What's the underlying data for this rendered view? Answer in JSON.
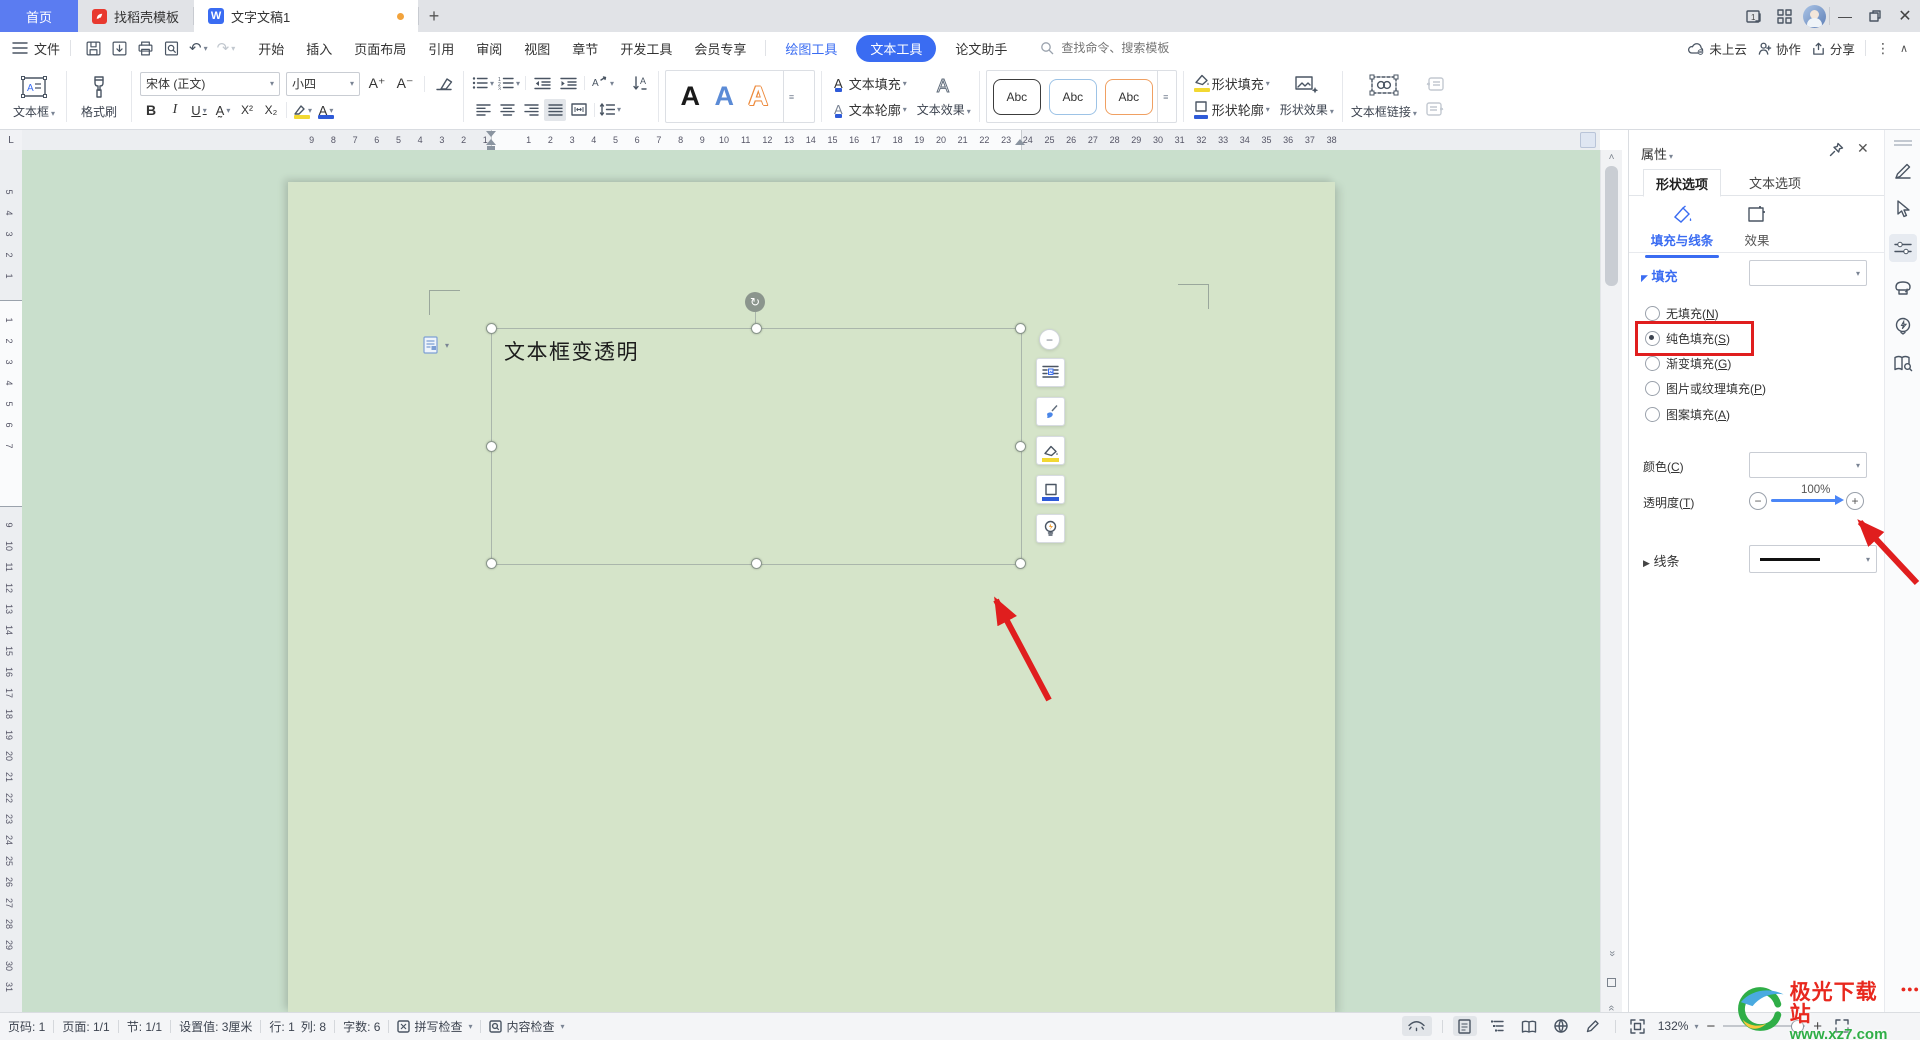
{
  "tabbar": {
    "home": "首页",
    "docer": "找稻壳模板",
    "doc": "文字文稿1"
  },
  "menubar": {
    "file": "文件",
    "items": [
      "开始",
      "插入",
      "页面布局",
      "引用",
      "审阅",
      "视图",
      "章节",
      "开发工具",
      "会员专享"
    ],
    "drawing_tools": "绘图工具",
    "text_tools": "文本工具",
    "paper_assistant": "论文助手",
    "search_placeholder": "查找命令、搜索模板",
    "cloud": "未上云",
    "collab": "协作",
    "share": "分享"
  },
  "ribbon": {
    "textbox": "文本框",
    "format_painter": "格式刷",
    "font_name": "宋体 (正文)",
    "font_size": "小四",
    "text_fill": "文本填充",
    "text_outline": "文本轮廓",
    "text_effects": "文本效果",
    "shape_fill": "形状填充",
    "shape_outline": "形状轮廓",
    "shape_effects": "形状效果",
    "textbox_link": "文本框链接",
    "style_samples": [
      "A",
      "A",
      "A"
    ],
    "abc_samples": [
      "Abc",
      "Abc",
      "Abc"
    ]
  },
  "document": {
    "textbox_text": "文本框变透明"
  },
  "panel": {
    "title": "属性",
    "tab_shape": "形状选项",
    "tab_text": "文本选项",
    "subtab_fill": "填充与线条",
    "subtab_effects": "效果",
    "fill_section": "填充",
    "fill_options": [
      {
        "pre": "无填充(",
        "key": "N",
        "post": ")",
        "selected": false
      },
      {
        "pre": "纯色填充(",
        "key": "S",
        "post": ")",
        "selected": true
      },
      {
        "pre": "渐变填充(",
        "key": "G",
        "post": ")",
        "selected": false
      },
      {
        "pre": "图片或纹理填充(",
        "key": "P",
        "post": ")",
        "selected": false
      },
      {
        "pre": "图案填充(",
        "key": "A",
        "post": ")",
        "selected": false
      }
    ],
    "color_pre": "颜色(",
    "color_key": "C",
    "color_post": ")",
    "transparency_pre": "透明度(",
    "transparency_key": "T",
    "transparency_post": ")",
    "transparency_value": "100%",
    "line_section": "线条"
  },
  "statusbar": {
    "page": "页码: 1",
    "pages": "页面: 1/1",
    "section": "节: 1/1",
    "setting": "设置值: 3厘米",
    "line": "行: 1",
    "column": "列: 8",
    "words": "字数: 6",
    "spell": "拼写检查",
    "content_check": "内容检查",
    "zoom": "132%"
  },
  "watermark": {
    "name": "极光下载站",
    "url": "www.xz7.com"
  },
  "ruler": {
    "h_left_max": 9,
    "h_right_max": 38,
    "v_top_max": 5,
    "v_band_max": 7,
    "v_bottom_start": 9,
    "v_bottom_end": 31
  }
}
